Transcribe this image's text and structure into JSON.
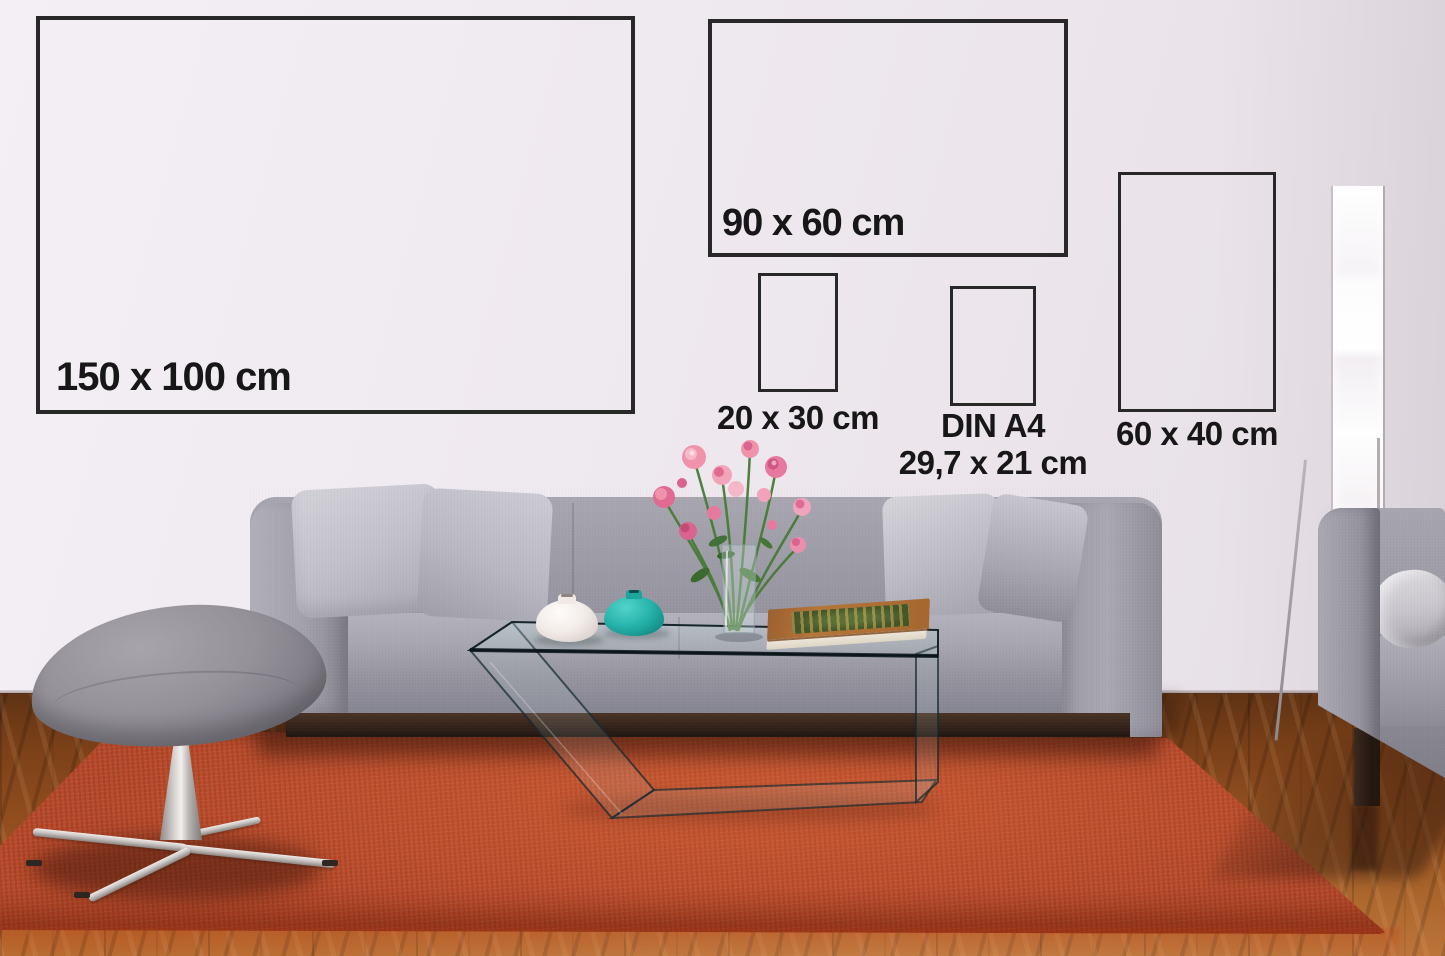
{
  "size_guide": {
    "items": [
      {
        "id": "150x100",
        "label": "150 x 100 cm"
      },
      {
        "id": "90x60",
        "label": "90 x 60 cm"
      },
      {
        "id": "20x30",
        "label": "20 x 30 cm"
      },
      {
        "id": "din-a4",
        "label": "DIN A4",
        "sublabel": "29,7 x 21 cm"
      },
      {
        "id": "60x40",
        "label": "60 x 40 cm"
      }
    ]
  },
  "colors": {
    "wall": "#ece7ed",
    "label_text": "#171717",
    "frame_outline": "#282828",
    "sofa_fabric": "#9a99a4",
    "rug": "#b8492a",
    "wood_floor": "#8a4b1f",
    "vase_teal": "#27b3ab",
    "vase_white": "#f4efec",
    "flowers_pink": "#e8799e"
  }
}
